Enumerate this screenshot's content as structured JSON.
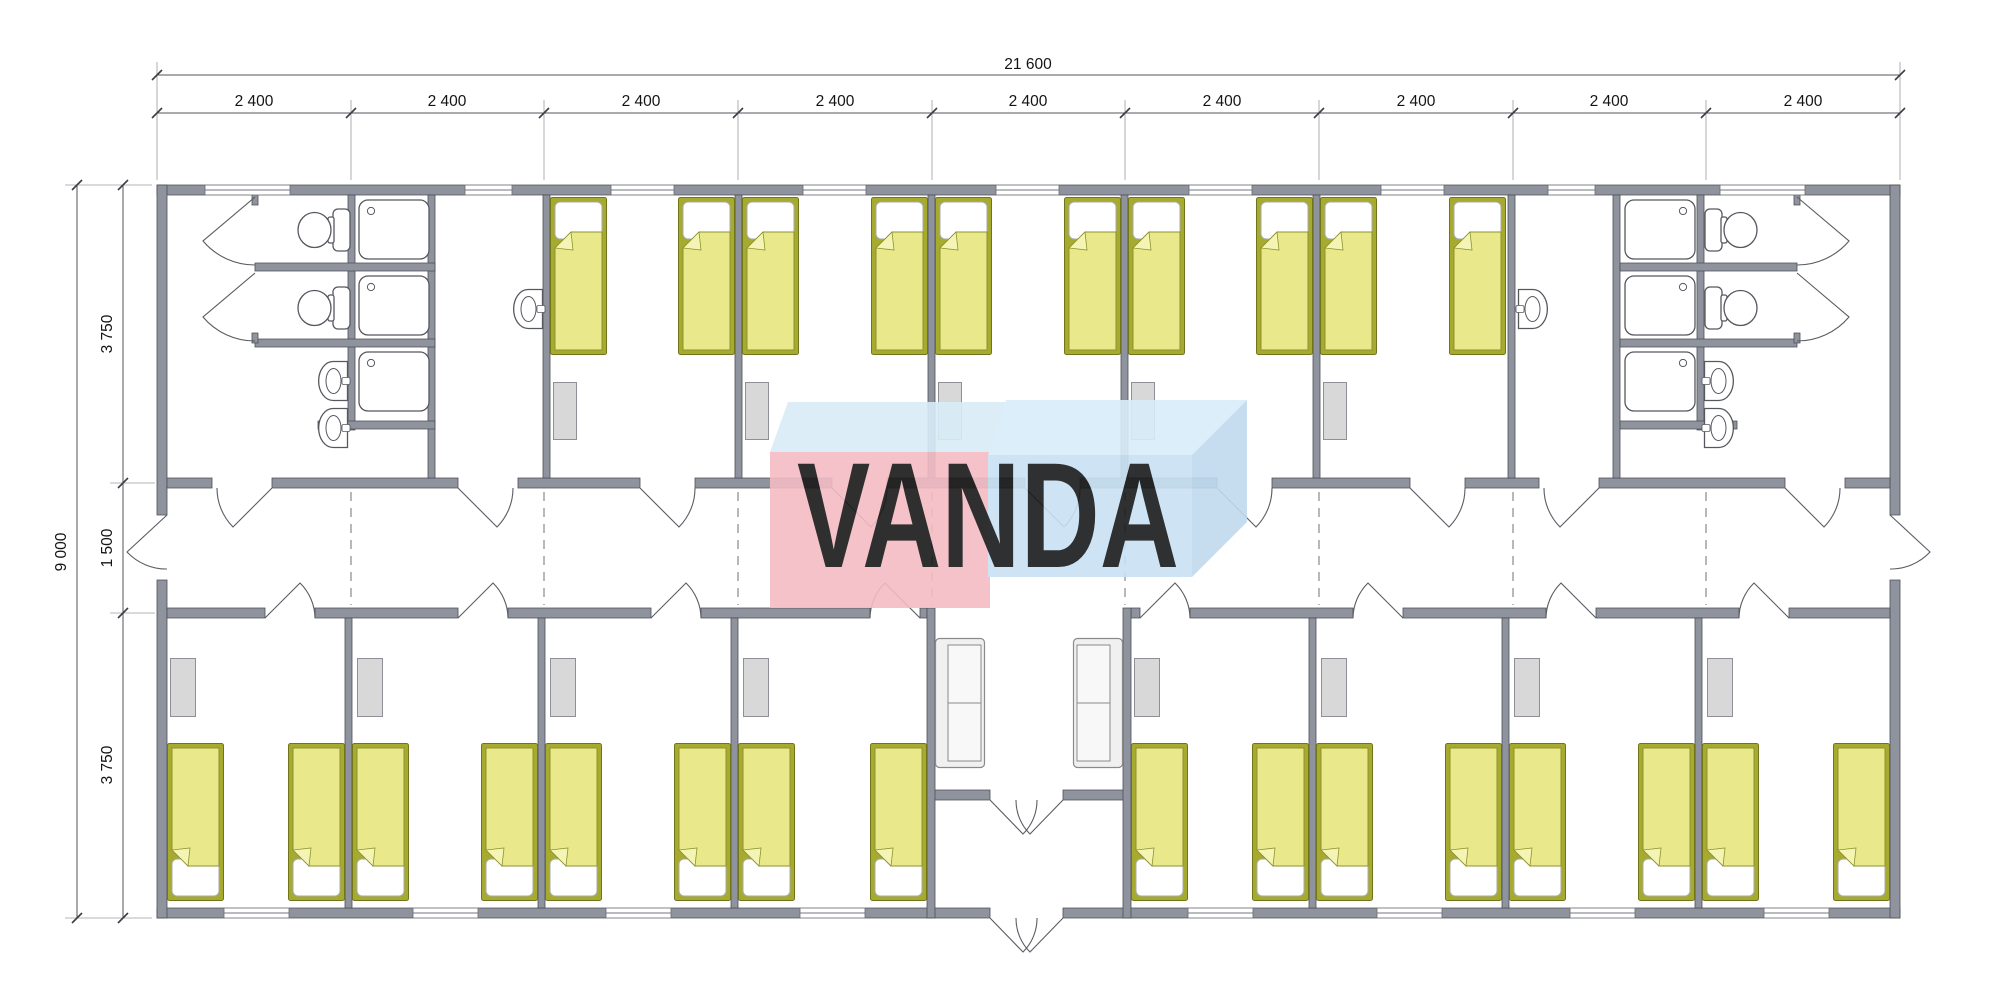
{
  "watermark": {
    "text": "VANDA",
    "colors": {
      "pink_face": "#f3bcc3",
      "blue_face": "#c9e2f4",
      "light_blue_top": "#d9edfa",
      "text": "#ffffff"
    }
  },
  "dimensions": {
    "overall_width_label": "21 600",
    "top_segments": [
      {
        "label": "2 400"
      },
      {
        "label": "2 400"
      },
      {
        "label": "2 400"
      },
      {
        "label": "2 400"
      },
      {
        "label": "2 400"
      },
      {
        "label": "2 400"
      },
      {
        "label": "2 400"
      },
      {
        "label": "2 400"
      },
      {
        "label": "2 400"
      }
    ],
    "overall_height_label": "9 000",
    "left_segments": [
      {
        "label": "3 750"
      },
      {
        "label": "1 500"
      },
      {
        "label": "3 750"
      }
    ]
  },
  "colors": {
    "wall": "#8f939d",
    "wall_stroke": "#4d4f56",
    "bed_frame": "#a6aa2f",
    "bed_blanket": "#e9e98c",
    "bed_fold": "#f4f4b5",
    "pillow": "#ffffff",
    "wardrobe": "#d8d8d8",
    "fixture_stroke": "#565860",
    "dimension_text": "#141414"
  },
  "plan": {
    "building": {
      "width_mm": 21600,
      "depth_mm": 9000,
      "modules": 9,
      "module_width_mm": 2400
    },
    "zones": {
      "top_band_mm": 3750,
      "corridor_mm": 1500,
      "bottom_band_mm": 3750
    },
    "rooms": {
      "bedrooms_top": 5,
      "bedrooms_bottom": 8,
      "bathrooms": 2,
      "wash_lobbies": 2,
      "entrance_lounge": 1
    },
    "fixtures": {
      "beds": 26,
      "showers": 6,
      "toilets": 4,
      "sinks": 6,
      "wardrobes": 13,
      "sofas": 2
    }
  }
}
